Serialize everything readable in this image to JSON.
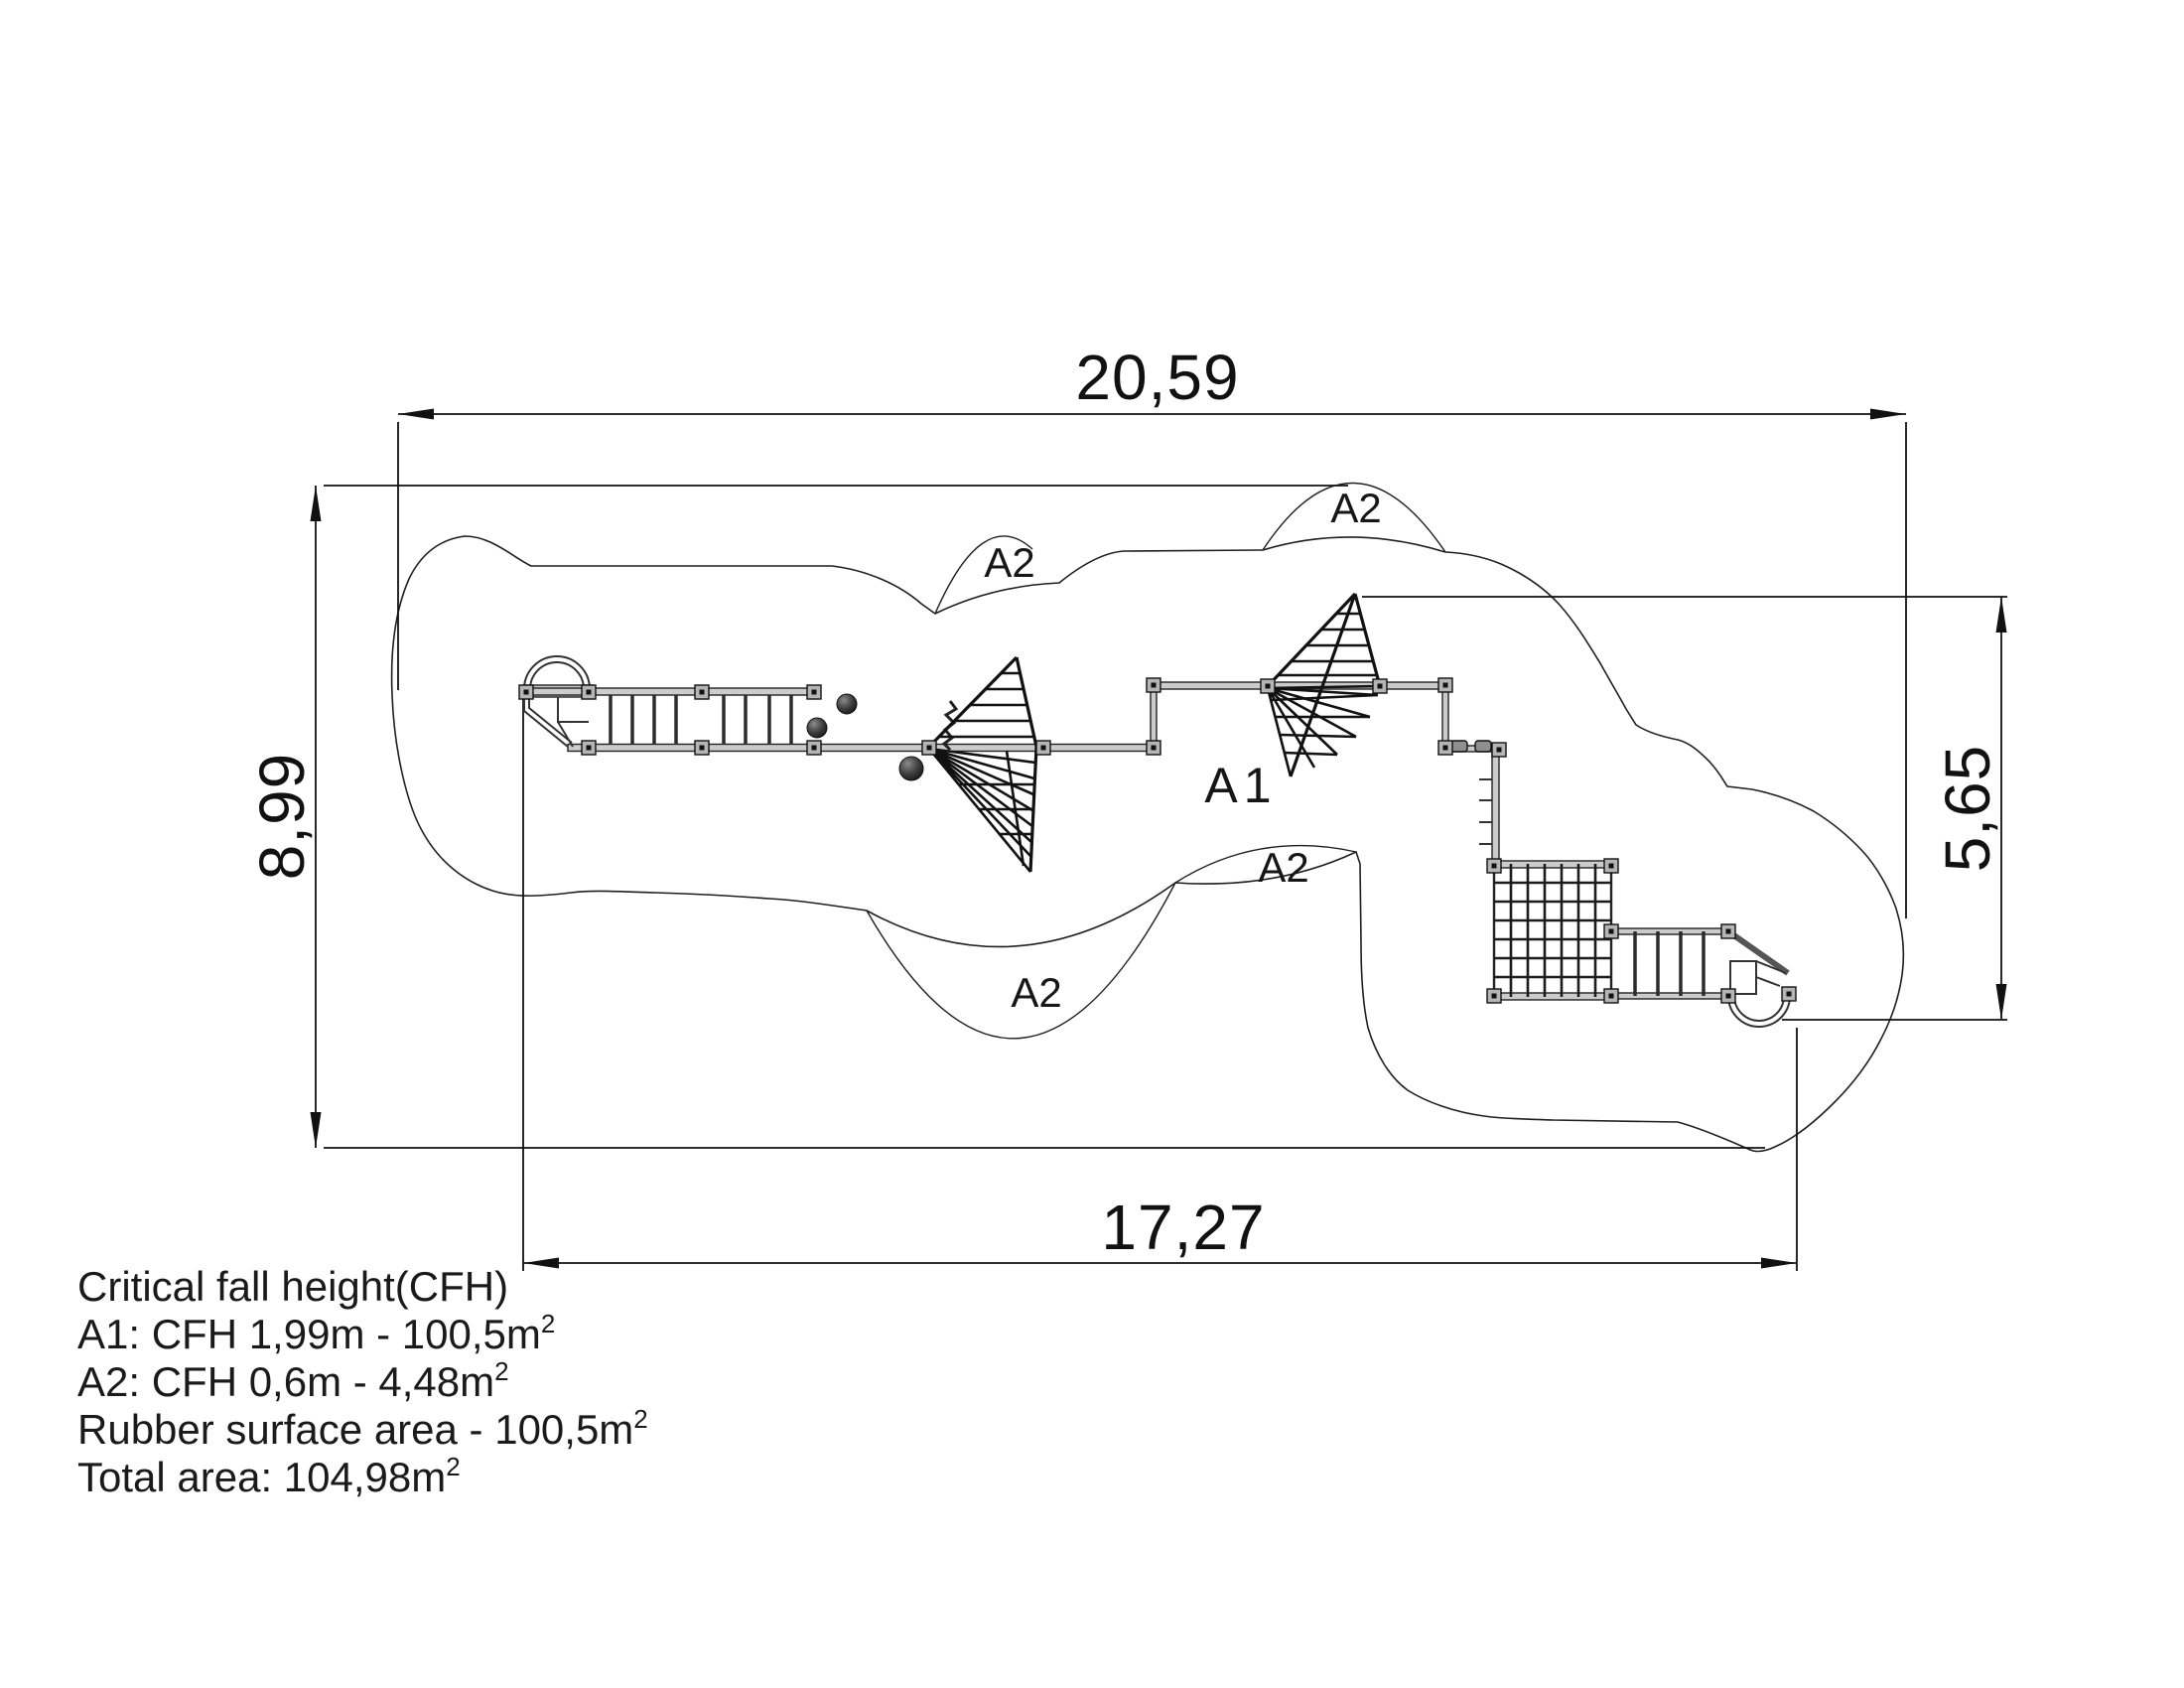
{
  "drawing": {
    "dimensions": {
      "overall_width": "20,59",
      "overall_depth": "8,99",
      "right_height": "5,65",
      "equipment_width": "17,27"
    },
    "zones": {
      "a1_label": "A1",
      "a2_label": "A2"
    },
    "notes": {
      "lines": [
        {
          "text": "Critical fall height(CFH)",
          "sup": ""
        },
        {
          "text": "A1: CFH 1,99m - 100,5m",
          "sup": "2"
        },
        {
          "text": "A2: CFH 0,6m - 4,48m",
          "sup": "2"
        },
        {
          "text": "Rubber surface area - 100,5m",
          "sup": "2"
        },
        {
          "text": "Total area: 104,98m",
          "sup": "2"
        }
      ]
    },
    "colors": {
      "line": "#1a1a1a",
      "beam_fill": "#cccccc",
      "ball": "#222222",
      "background": "#ffffff"
    }
  }
}
